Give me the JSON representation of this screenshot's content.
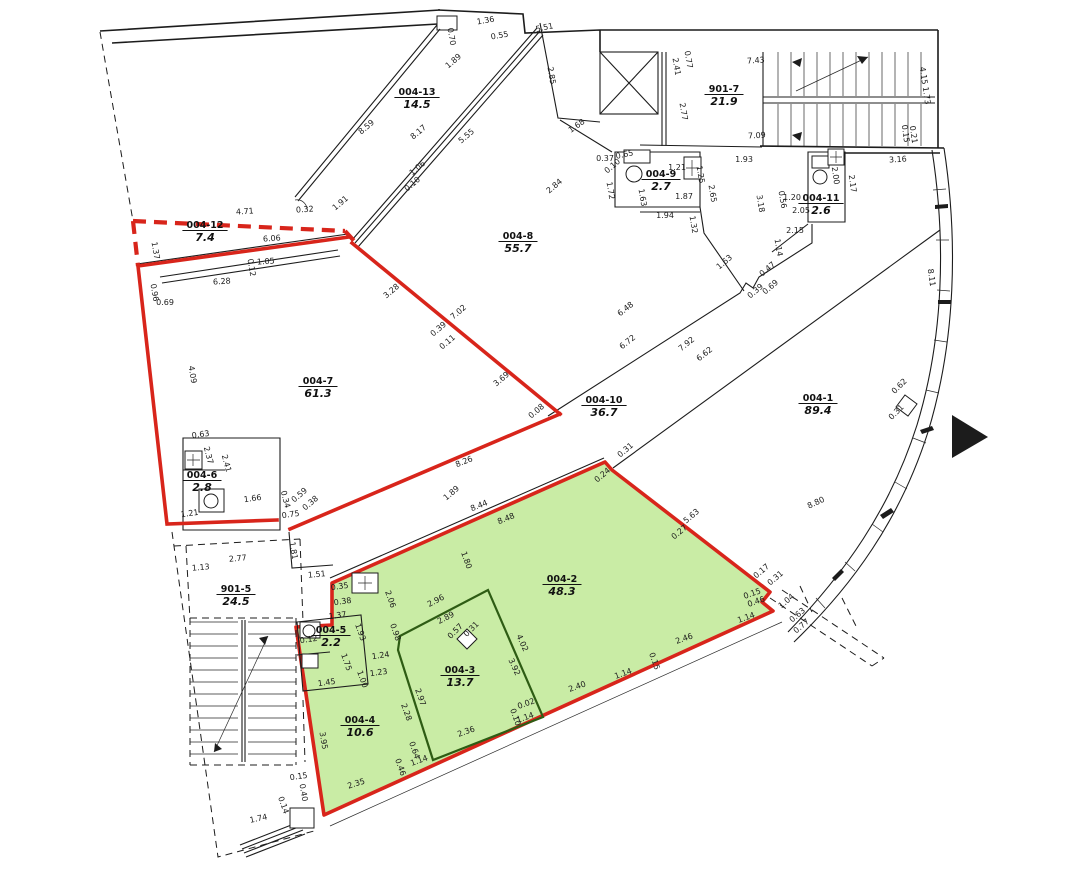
{
  "colors": {
    "red_boundary": "#d8251b",
    "green_fill": "#c9eca5",
    "green_partition": "#2e5c14",
    "wall": "#1c1c1c",
    "background": "#ffffff"
  },
  "rooms": [
    {
      "id": "004-12",
      "area": "7.4",
      "x": 205,
      "y": 228
    },
    {
      "id": "004-13",
      "area": "14.5",
      "x": 417,
      "y": 95
    },
    {
      "id": "901-7",
      "area": "21.9",
      "x": 724,
      "y": 92
    },
    {
      "id": "004-9",
      "area": "2.7",
      "x": 661,
      "y": 177
    },
    {
      "id": "004-11",
      "area": "2.6",
      "x": 821,
      "y": 201
    },
    {
      "id": "004-8",
      "area": "55.7",
      "x": 518,
      "y": 239
    },
    {
      "id": "004-7",
      "area": "61.3",
      "x": 318,
      "y": 384
    },
    {
      "id": "004-6",
      "area": "2.8",
      "x": 202,
      "y": 478
    },
    {
      "id": "004-10",
      "area": "36.7",
      "x": 604,
      "y": 403
    },
    {
      "id": "004-1",
      "area": "89.4",
      "x": 818,
      "y": 401
    },
    {
      "id": "901-5",
      "area": "24.5",
      "x": 236,
      "y": 592
    },
    {
      "id": "004-5",
      "area": "2.2",
      "x": 331,
      "y": 633
    },
    {
      "id": "004-4",
      "area": "10.6",
      "x": 360,
      "y": 723
    },
    {
      "id": "004-3",
      "area": "13.7",
      "x": 460,
      "y": 673
    },
    {
      "id": "004-2",
      "area": "48.3",
      "x": 562,
      "y": 582
    }
  ],
  "dimensions": [
    {
      "t": "4.71",
      "x": 245,
      "y": 214,
      "r": -4
    },
    {
      "t": "0.32",
      "x": 305,
      "y": 212,
      "r": -4
    },
    {
      "t": "6.06",
      "x": 272,
      "y": 241,
      "r": -4
    },
    {
      "t": "6.28",
      "x": 222,
      "y": 284,
      "r": -4
    },
    {
      "t": "1.05",
      "x": 266,
      "y": 264,
      "r": -4
    },
    {
      "t": "0.12",
      "x": 249,
      "y": 268,
      "r": 80
    },
    {
      "t": "1.37",
      "x": 153,
      "y": 251,
      "r": 80
    },
    {
      "t": "0.96",
      "x": 152,
      "y": 293,
      "r": 80
    },
    {
      "t": "0.69",
      "x": 165,
      "y": 305,
      "r": 0
    },
    {
      "t": "4.09",
      "x": 190,
      "y": 375,
      "r": 80
    },
    {
      "t": "1.91",
      "x": 342,
      "y": 205,
      "r": -40
    },
    {
      "t": "8.59",
      "x": 368,
      "y": 129,
      "r": -40
    },
    {
      "t": "8.17",
      "x": 420,
      "y": 134,
      "r": -40
    },
    {
      "t": "5.55",
      "x": 468,
      "y": 138,
      "r": -40
    },
    {
      "t": "1.89",
      "x": 455,
      "y": 63,
      "r": -40
    },
    {
      "t": "1.06",
      "x": 419,
      "y": 170,
      "r": -40
    },
    {
      "t": "0.10",
      "x": 414,
      "y": 186,
      "r": -40
    },
    {
      "t": "0.70",
      "x": 449,
      "y": 37,
      "r": 80
    },
    {
      "t": "1.36",
      "x": 486,
      "y": 23,
      "r": -10
    },
    {
      "t": "0.55",
      "x": 500,
      "y": 38,
      "r": -10
    },
    {
      "t": "5.51",
      "x": 545,
      "y": 30,
      "r": -12
    },
    {
      "t": "2.85",
      "x": 549,
      "y": 76,
      "r": 80
    },
    {
      "t": "1.68",
      "x": 578,
      "y": 128,
      "r": -35
    },
    {
      "t": "2.84",
      "x": 556,
      "y": 188,
      "r": -40
    },
    {
      "t": "0.37",
      "x": 605,
      "y": 161,
      "r": 0
    },
    {
      "t": "0.10",
      "x": 614,
      "y": 168,
      "r": -40
    },
    {
      "t": "0.65",
      "x": 625,
      "y": 157,
      "r": -12
    },
    {
      "t": "1.72",
      "x": 608,
      "y": 191,
      "r": 80
    },
    {
      "t": "1.63",
      "x": 640,
      "y": 198,
      "r": 80
    },
    {
      "t": "1.21",
      "x": 677,
      "y": 170,
      "r": 0
    },
    {
      "t": "1.25",
      "x": 698,
      "y": 175,
      "r": 80
    },
    {
      "t": "1.87",
      "x": 684,
      "y": 199,
      "r": 0
    },
    {
      "t": "1.94",
      "x": 665,
      "y": 218,
      "r": 0
    },
    {
      "t": "1.32",
      "x": 691,
      "y": 225,
      "r": 80
    },
    {
      "t": "2.65",
      "x": 710,
      "y": 194,
      "r": 80
    },
    {
      "t": "1.93",
      "x": 744,
      "y": 162,
      "r": 0
    },
    {
      "t": "2.41",
      "x": 674,
      "y": 67,
      "r": 80
    },
    {
      "t": "0.77",
      "x": 686,
      "y": 60,
      "r": 80
    },
    {
      "t": "2.77",
      "x": 681,
      "y": 112,
      "r": 80
    },
    {
      "t": "7.43",
      "x": 756,
      "y": 63,
      "r": -4
    },
    {
      "t": "7.09",
      "x": 757,
      "y": 138,
      "r": -3
    },
    {
      "t": "4.15",
      "x": 921,
      "y": 76,
      "r": 82
    },
    {
      "t": "1.73",
      "x": 924,
      "y": 96,
      "r": 82
    },
    {
      "t": "0.15",
      "x": 903,
      "y": 134,
      "r": 82
    },
    {
      "t": "0.21",
      "x": 911,
      "y": 135,
      "r": 82
    },
    {
      "t": "3.16",
      "x": 898,
      "y": 162,
      "r": -3
    },
    {
      "t": "3.18",
      "x": 758,
      "y": 204,
      "r": 80
    },
    {
      "t": "0.56",
      "x": 780,
      "y": 200,
      "r": 80
    },
    {
      "t": "1.20",
      "x": 792,
      "y": 200,
      "r": 0
    },
    {
      "t": "2.05",
      "x": 801,
      "y": 213,
      "r": 0
    },
    {
      "t": "2.15",
      "x": 795,
      "y": 233,
      "r": 0
    },
    {
      "t": "1.14",
      "x": 776,
      "y": 248,
      "r": 80
    },
    {
      "t": "2.00",
      "x": 833,
      "y": 176,
      "r": 82
    },
    {
      "t": "2.17",
      "x": 850,
      "y": 184,
      "r": 82
    },
    {
      "t": "1.63",
      "x": 726,
      "y": 264,
      "r": -40
    },
    {
      "t": "0.47",
      "x": 769,
      "y": 271,
      "r": -40
    },
    {
      "t": "0.69",
      "x": 772,
      "y": 289,
      "r": -40
    },
    {
      "t": "0.39",
      "x": 757,
      "y": 293,
      "r": -40
    },
    {
      "t": "8.11",
      "x": 929,
      "y": 278,
      "r": 82
    },
    {
      "t": "6.48",
      "x": 627,
      "y": 311,
      "r": -38
    },
    {
      "t": "6.72",
      "x": 629,
      "y": 344,
      "r": -38
    },
    {
      "t": "7.92",
      "x": 688,
      "y": 346,
      "r": -38
    },
    {
      "t": "6.62",
      "x": 706,
      "y": 356,
      "r": -38
    },
    {
      "t": "3.28",
      "x": 393,
      "y": 293,
      "r": -40
    },
    {
      "t": "7.02",
      "x": 460,
      "y": 314,
      "r": -40
    },
    {
      "t": "0.39",
      "x": 440,
      "y": 331,
      "r": -40
    },
    {
      "t": "0.11",
      "x": 449,
      "y": 344,
      "r": -40
    },
    {
      "t": "3.69",
      "x": 503,
      "y": 381,
      "r": -40
    },
    {
      "t": "0.08",
      "x": 538,
      "y": 413,
      "r": -40
    },
    {
      "t": "1.89",
      "x": 453,
      "y": 495,
      "r": -40
    },
    {
      "t": "8.26",
      "x": 465,
      "y": 464,
      "r": -22
    },
    {
      "t": "8.44",
      "x": 480,
      "y": 508,
      "r": -22
    },
    {
      "t": "8.48",
      "x": 507,
      "y": 521,
      "r": -22
    },
    {
      "t": "1.80",
      "x": 464,
      "y": 561,
      "r": 70
    },
    {
      "t": "0.31",
      "x": 627,
      "y": 452,
      "r": -40
    },
    {
      "t": "0.24",
      "x": 604,
      "y": 477,
      "r": -40
    },
    {
      "t": "5.63",
      "x": 693,
      "y": 518,
      "r": -40
    },
    {
      "t": "0.27",
      "x": 681,
      "y": 534,
      "r": -40
    },
    {
      "t": "0.17",
      "x": 763,
      "y": 573,
      "r": -40
    },
    {
      "t": "0.31",
      "x": 777,
      "y": 580,
      "r": -40
    },
    {
      "t": "1.04",
      "x": 788,
      "y": 603,
      "r": -40
    },
    {
      "t": "0.63",
      "x": 799,
      "y": 617,
      "r": -40
    },
    {
      "t": "0.77",
      "x": 803,
      "y": 628,
      "r": -40
    },
    {
      "t": "0.15",
      "x": 753,
      "y": 596,
      "r": -20
    },
    {
      "t": "0.46",
      "x": 757,
      "y": 604,
      "r": -20
    },
    {
      "t": "1.14",
      "x": 747,
      "y": 620,
      "r": -20
    },
    {
      "t": "2.46",
      "x": 685,
      "y": 641,
      "r": -20
    },
    {
      "t": "0.15",
      "x": 652,
      "y": 662,
      "r": 70
    },
    {
      "t": "1.14",
      "x": 624,
      "y": 676,
      "r": -20
    },
    {
      "t": "2.40",
      "x": 578,
      "y": 689,
      "r": -20
    },
    {
      "t": "0.02",
      "x": 527,
      "y": 706,
      "r": -20
    },
    {
      "t": "0.10",
      "x": 513,
      "y": 718,
      "r": 70
    },
    {
      "t": "1.14",
      "x": 526,
      "y": 720,
      "r": -20
    },
    {
      "t": "4.02",
      "x": 520,
      "y": 644,
      "r": 65
    },
    {
      "t": "3.92",
      "x": 512,
      "y": 668,
      "r": 65
    },
    {
      "t": "2.96",
      "x": 437,
      "y": 603,
      "r": -28
    },
    {
      "t": "2.89",
      "x": 447,
      "y": 620,
      "r": -28
    },
    {
      "t": "0.57",
      "x": 457,
      "y": 633,
      "r": -45
    },
    {
      "t": "0.31",
      "x": 473,
      "y": 631,
      "r": -45
    },
    {
      "t": "2.06",
      "x": 388,
      "y": 600,
      "r": 70
    },
    {
      "t": "0.98",
      "x": 393,
      "y": 633,
      "r": 70
    },
    {
      "t": "1.24",
      "x": 381,
      "y": 658,
      "r": -8
    },
    {
      "t": "1.23",
      "x": 379,
      "y": 675,
      "r": -8
    },
    {
      "t": "2.97",
      "x": 418,
      "y": 698,
      "r": 70
    },
    {
      "t": "2.28",
      "x": 404,
      "y": 713,
      "r": 70
    },
    {
      "t": "2.36",
      "x": 467,
      "y": 734,
      "r": -20
    },
    {
      "t": "0.64",
      "x": 412,
      "y": 751,
      "r": 70
    },
    {
      "t": "1.14",
      "x": 420,
      "y": 763,
      "r": -20
    },
    {
      "t": "0.46",
      "x": 398,
      "y": 768,
      "r": 70
    },
    {
      "t": "3.95",
      "x": 321,
      "y": 741,
      "r": 80
    },
    {
      "t": "2.35",
      "x": 357,
      "y": 786,
      "r": -18
    },
    {
      "t": "0.15",
      "x": 299,
      "y": 779,
      "r": -8
    },
    {
      "t": "0.40",
      "x": 301,
      "y": 793,
      "r": 80
    },
    {
      "t": "1.74",
      "x": 259,
      "y": 821,
      "r": -12
    },
    {
      "t": "0.14",
      "x": 281,
      "y": 806,
      "r": 70
    },
    {
      "t": "1.13",
      "x": 201,
      "y": 570,
      "r": -5
    },
    {
      "t": "2.77",
      "x": 238,
      "y": 561,
      "r": -5
    },
    {
      "t": "1.51",
      "x": 317,
      "y": 577,
      "r": -5
    },
    {
      "t": "1.81",
      "x": 291,
      "y": 551,
      "r": 80
    },
    {
      "t": "1.37",
      "x": 338,
      "y": 618,
      "r": -8
    },
    {
      "t": "0.12",
      "x": 309,
      "y": 642,
      "r": -8
    },
    {
      "t": "1.93",
      "x": 358,
      "y": 633,
      "r": 70
    },
    {
      "t": "1.75",
      "x": 344,
      "y": 663,
      "r": 70
    },
    {
      "t": "1.45",
      "x": 327,
      "y": 685,
      "r": -8
    },
    {
      "t": "1.00",
      "x": 360,
      "y": 680,
      "r": 70
    },
    {
      "t": "0.35",
      "x": 340,
      "y": 589,
      "r": -8
    },
    {
      "t": "0.38",
      "x": 343,
      "y": 604,
      "r": -8
    },
    {
      "t": "0.63",
      "x": 201,
      "y": 437,
      "r": -8
    },
    {
      "t": "2.37",
      "x": 206,
      "y": 456,
      "r": 75
    },
    {
      "t": "2.41",
      "x": 224,
      "y": 464,
      "r": 75
    },
    {
      "t": "1.66",
      "x": 253,
      "y": 501,
      "r": -8
    },
    {
      "t": "1.21",
      "x": 190,
      "y": 516,
      "r": -8
    },
    {
      "t": "0.75",
      "x": 291,
      "y": 517,
      "r": -8
    },
    {
      "t": "0.34",
      "x": 283,
      "y": 500,
      "r": 75
    },
    {
      "t": "0.59",
      "x": 301,
      "y": 497,
      "r": -40
    },
    {
      "t": "0.38",
      "x": 312,
      "y": 505,
      "r": -40
    },
    {
      "t": "8.80",
      "x": 817,
      "y": 505,
      "r": -25
    },
    {
      "t": "0.62",
      "x": 901,
      "y": 388,
      "r": -45
    },
    {
      "t": "0.31",
      "x": 898,
      "y": 414,
      "r": -45
    }
  ]
}
